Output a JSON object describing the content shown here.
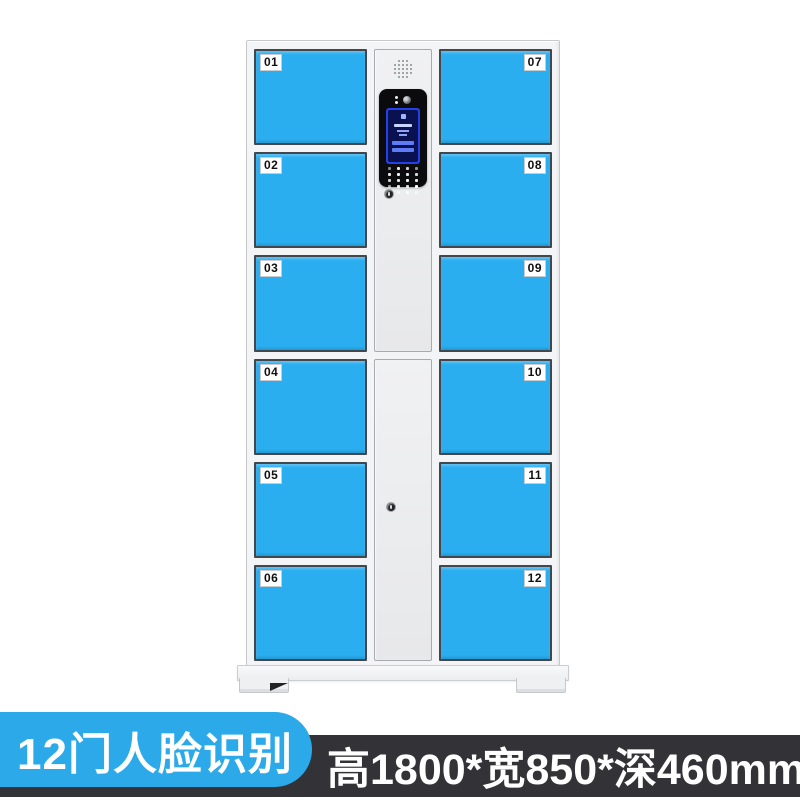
{
  "locker": {
    "left_doors": [
      "01",
      "02",
      "03",
      "04",
      "05",
      "06"
    ],
    "right_doors": [
      "07",
      "08",
      "09",
      "10",
      "11",
      "12"
    ]
  },
  "footer": {
    "badge": "12门人脸识别",
    "dimensions": "高1800*宽850*深460mm"
  },
  "colors": {
    "door_blue": "#2AAEF0",
    "badge_blue": "#2BA9E9",
    "banner_dark": "#333236",
    "screen_blue": "#2640E8"
  }
}
